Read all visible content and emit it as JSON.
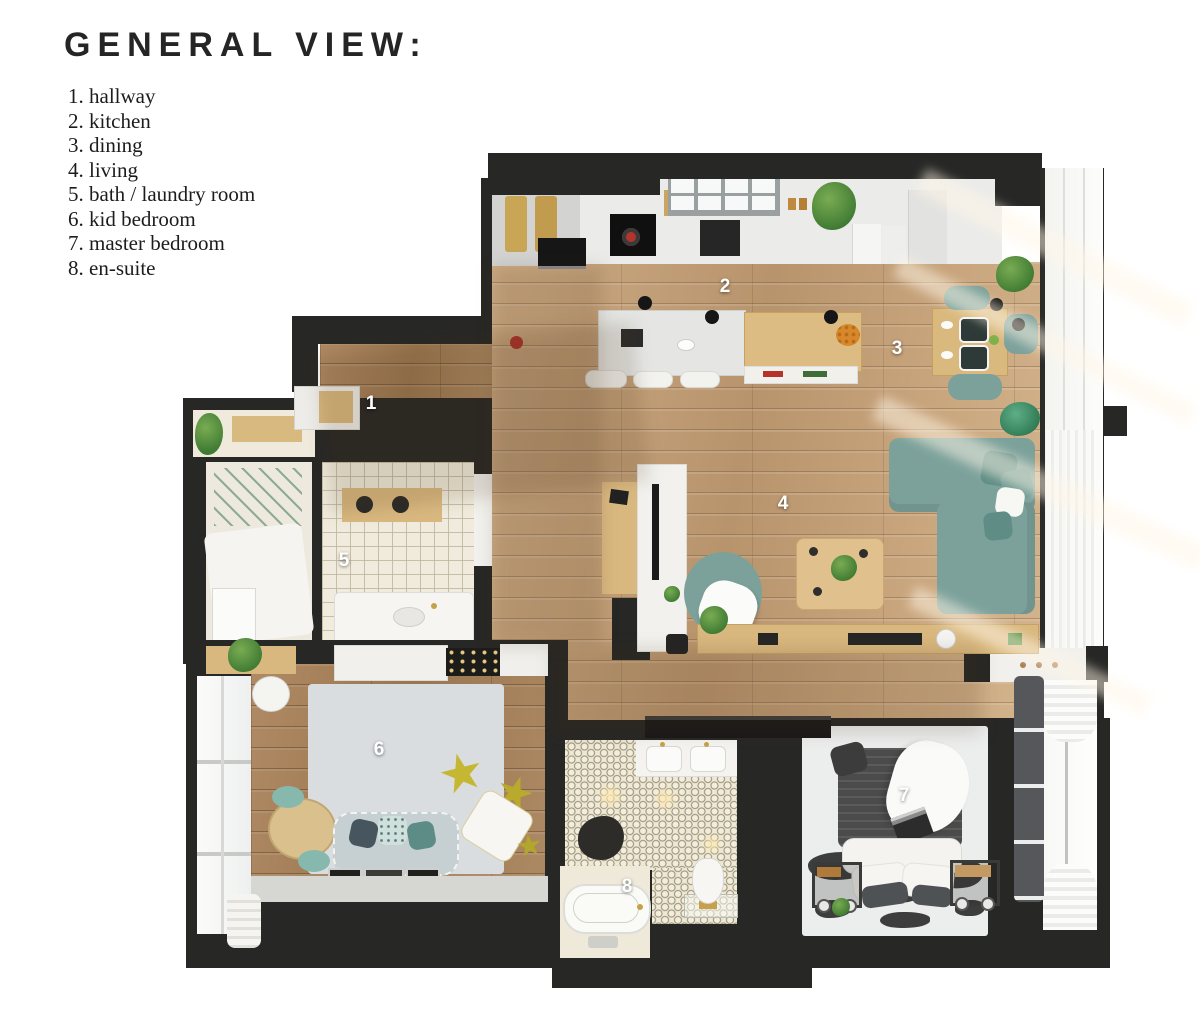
{
  "header": {
    "title": "GENERAL VIEW:"
  },
  "legend": {
    "items": [
      "1. hallway",
      "2. kitchen",
      "3. dining",
      "4. living",
      "5. bath / laundry room",
      "6. kid bedroom",
      "7. master bedroom",
      "8. en-suite"
    ]
  },
  "plan": {
    "room_labels": [
      {
        "num": "1",
        "name": "hallway",
        "x": 371,
        "y": 404
      },
      {
        "num": "2",
        "name": "kitchen",
        "x": 725,
        "y": 287
      },
      {
        "num": "3",
        "name": "dining",
        "x": 897,
        "y": 349
      },
      {
        "num": "4",
        "name": "living",
        "x": 783,
        "y": 504
      },
      {
        "num": "5",
        "name": "bath / laundry room",
        "x": 344,
        "y": 561
      },
      {
        "num": "6",
        "name": "kid bedroom",
        "x": 379,
        "y": 750
      },
      {
        "num": "7",
        "name": "master bedroom",
        "x": 904,
        "y": 796
      },
      {
        "num": "8",
        "name": "en-suite",
        "x": 627,
        "y": 887
      }
    ],
    "colors": {
      "wall": "#272725",
      "wood_floor": "#c5a37d",
      "tile_floor": "#f0ebdc",
      "hex_tile_floor": "#efe8d3",
      "sofa_teal": "#7ca19b",
      "accent_yellow": "#c6b733",
      "kid_rug": "#d9dde0",
      "bed_duvet": "#4b4b4b",
      "plant_green": "#4f8c3c"
    }
  }
}
